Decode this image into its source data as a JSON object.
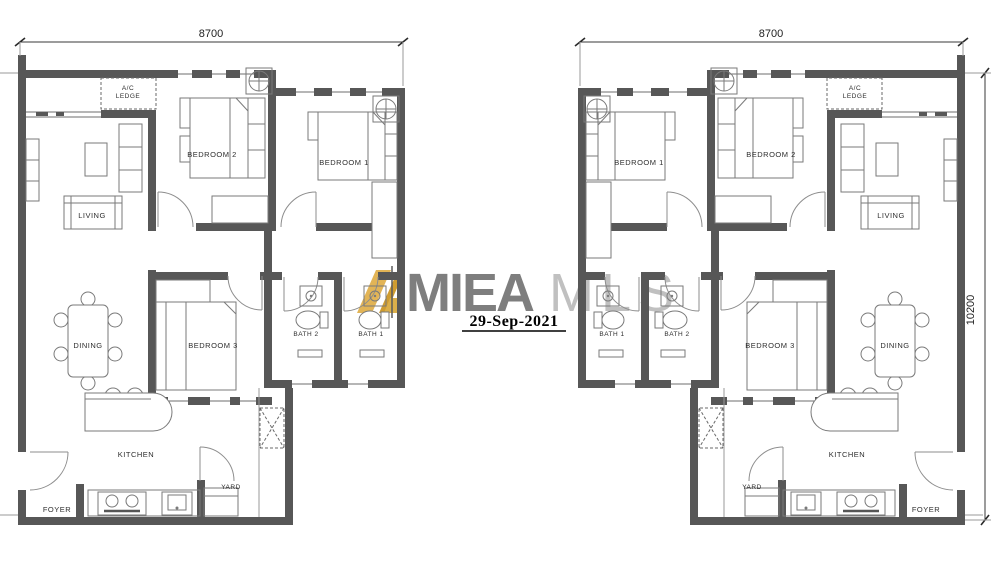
{
  "page": {
    "background": "#ffffff",
    "type": "floor-plan",
    "description": "Two mirrored 3-bedroom unit floor plans"
  },
  "watermark": {
    "brand_primary": "MIEA",
    "brand_secondary": "MLS",
    "date": "29-Sep-2021",
    "colors": {
      "primary": "#7e7e7e",
      "secondary": "#c0c0c0",
      "logo_gold_light": "#e2b456",
      "logo_gold_dark": "#cf9c30",
      "date": "#000000"
    }
  },
  "dimensions": {
    "left_unit_width": "8700",
    "right_unit_width": "8700",
    "right_unit_height": "10200"
  },
  "colors": {
    "wall": "#575757",
    "furniture_line": "#7a7a7a",
    "label": "#2e2e2e",
    "dimension": "#3a3a3a"
  },
  "units": [
    {
      "id": "left",
      "rooms": [
        {
          "name": "ac-ledge",
          "lines": [
            "A/C",
            "LEDGE"
          ],
          "x": 128,
          "y": 90,
          "small": true
        },
        {
          "name": "bedroom-2",
          "label": "BEDROOM 2",
          "x": 212,
          "y": 157
        },
        {
          "name": "bedroom-1",
          "label": "BEDROOM 1",
          "x": 344,
          "y": 165
        },
        {
          "name": "living",
          "label": "LIVING",
          "x": 92,
          "y": 218
        },
        {
          "name": "dining",
          "label": "DINING",
          "x": 88,
          "y": 348
        },
        {
          "name": "bedroom-3",
          "label": "BEDROOM 3",
          "x": 213,
          "y": 348
        },
        {
          "name": "bath-2",
          "label": "BATH 2",
          "x": 306,
          "y": 336,
          "small": true
        },
        {
          "name": "bath-1",
          "label": "BATH 1",
          "x": 371,
          "y": 336,
          "small": true
        },
        {
          "name": "kitchen",
          "label": "KITCHEN",
          "x": 136,
          "y": 457
        },
        {
          "name": "yard",
          "label": "YARD",
          "x": 231,
          "y": 489,
          "small": true
        },
        {
          "name": "foyer",
          "label": "FOYER",
          "x": 57,
          "y": 512
        }
      ]
    },
    {
      "id": "right",
      "rooms": [
        {
          "name": "ac-ledge",
          "lines": [
            "A/C",
            "LEDGE"
          ],
          "x": 855,
          "y": 90,
          "small": true
        },
        {
          "name": "bedroom-1",
          "label": "BEDROOM 1",
          "x": 639,
          "y": 165
        },
        {
          "name": "bedroom-2",
          "label": "BEDROOM 2",
          "x": 771,
          "y": 157
        },
        {
          "name": "living",
          "label": "LIVING",
          "x": 891,
          "y": 218
        },
        {
          "name": "bath-1",
          "label": "BATH 1",
          "x": 612,
          "y": 336,
          "small": true
        },
        {
          "name": "bath-2",
          "label": "BATH 2",
          "x": 677,
          "y": 336,
          "small": true
        },
        {
          "name": "bedroom-3",
          "label": "BEDROOM 3",
          "x": 770,
          "y": 348
        },
        {
          "name": "dining",
          "label": "DINING",
          "x": 895,
          "y": 348
        },
        {
          "name": "yard",
          "label": "YARD",
          "x": 752,
          "y": 489,
          "small": true
        },
        {
          "name": "kitchen",
          "label": "KITCHEN",
          "x": 847,
          "y": 457
        },
        {
          "name": "foyer",
          "label": "FOYER",
          "x": 926,
          "y": 512
        }
      ]
    }
  ]
}
